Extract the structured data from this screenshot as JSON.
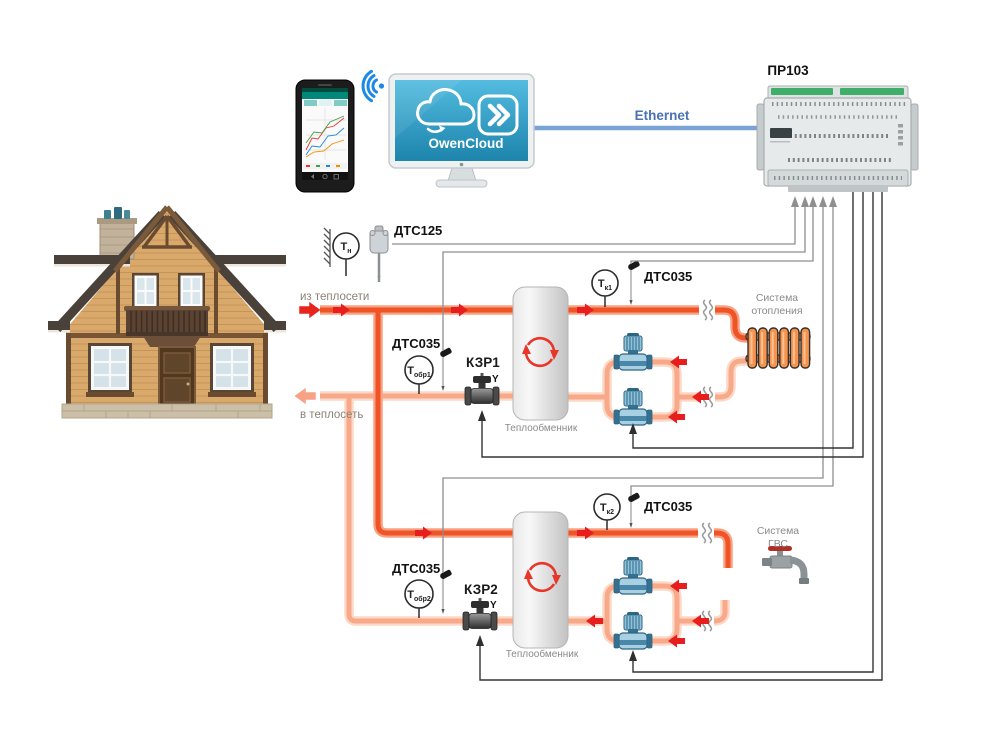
{
  "colors": {
    "pipe_supply": "#ee5426",
    "pipe_supply_edge": "#f7a182",
    "pipe_return": "#f7a98a",
    "pipe_return_edge": "#fcd9c6",
    "flow_arrow": "#e81e1e",
    "wire_sensor": "#8f8f8f",
    "wire_control": "#333333",
    "ethernet_line": "#7ba3d4",
    "ethernet_text": "#4a72b4",
    "screen_top": "#53bce0",
    "screen_bottom": "#1d84ac",
    "terminal_green": "#3fae68"
  },
  "cloud_app": {
    "brand": "OwenCloud"
  },
  "network": {
    "ethernet": "Ethernet"
  },
  "controller": {
    "model": "ПР103"
  },
  "sensors": {
    "dts125": "ДТС125",
    "dts035": "ДТС035",
    "tn": {
      "main": "Т",
      "sub": "н"
    },
    "tk1": {
      "main": "Т",
      "sub": "к1"
    },
    "tk2": {
      "main": "Т",
      "sub": "к2"
    },
    "tobr1": {
      "main": "Т",
      "sub": "обр1"
    },
    "tobr2": {
      "main": "Т",
      "sub": "обр2"
    }
  },
  "valves": {
    "kzr1": "КЗР1",
    "kzr2": "КЗР2",
    "y_mark": "Y"
  },
  "flows": {
    "from_network": "из теплосети",
    "to_network": "в теплосеть"
  },
  "equipment": {
    "heat_exchanger": "Теплообменник",
    "heating_system": {
      "line1": "Система",
      "line2": "отопления"
    },
    "dhw_system": {
      "line1": "Система",
      "line2": "ГВС"
    }
  }
}
